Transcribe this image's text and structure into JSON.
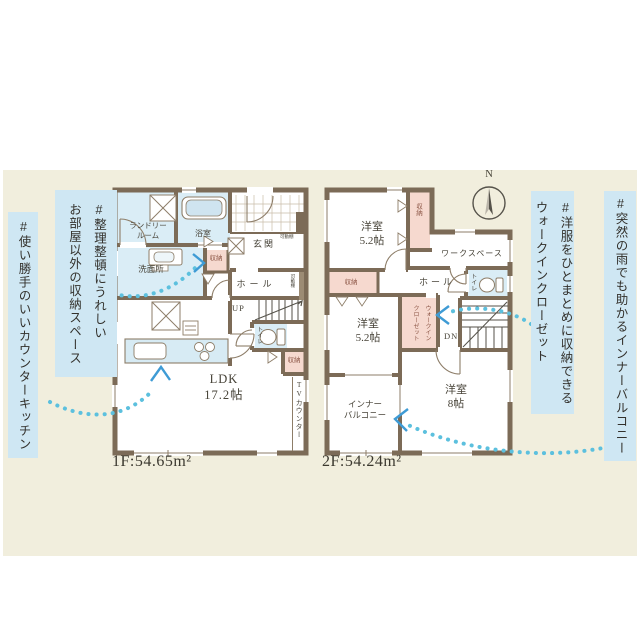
{
  "palette": {
    "band_bg": "#f1eedd",
    "callout_bg": "#cfe7f3",
    "wall": "#7c6b57",
    "water_room": "#daedf6",
    "storage_pink": "#f6d9cf",
    "dots_cyan": "#5cc0de",
    "arrow_blue": "#3e9bd5",
    "label_text": "#474338",
    "storage_text": "#8d5747"
  },
  "annotations": {
    "left_inner": "#整理整頓にうれしい\nお部屋以外の収納スペース",
    "left_outer": "#使い勝手のいいカウンターキッチン",
    "right_inner": "#洋服をひとまとめに収納できる\nウォークインクローゼット",
    "right_outer": "#突然の雨でも助かるインナーバルコニー"
  },
  "floor1": {
    "area_label": "1F:54.65m²",
    "rooms": {
      "laundry": "ランドリー\nルーム",
      "bath": "浴室",
      "entrance": "玄関",
      "washroom": "洗面所",
      "hall": "ホール",
      "stairs_up": "UP",
      "toilet": "トイレ",
      "storage_a": "収納",
      "storage_b": "収納",
      "shelf_a": "可動棚",
      "shelf_b": "可動棚",
      "tv_counter": "TVカウンター",
      "ldk": "LDK\n17.2帖"
    }
  },
  "floor2": {
    "area_label": "2F:54.24m²",
    "compass_n": "N",
    "rooms": {
      "bedroom_a": "洋室\n5.2帖",
      "bedroom_b": "洋室\n5.2帖",
      "bedroom_c": "洋室\n8帖",
      "workspace": "ワークスペース",
      "hall": "ホール",
      "stairs_down": "DN",
      "toilet": "トイレ",
      "storage_a": "収納",
      "storage_b": "収納",
      "wic": "ウォークイン\nクローゼット",
      "inner_balcony": "インナー\nバルコニー"
    }
  }
}
